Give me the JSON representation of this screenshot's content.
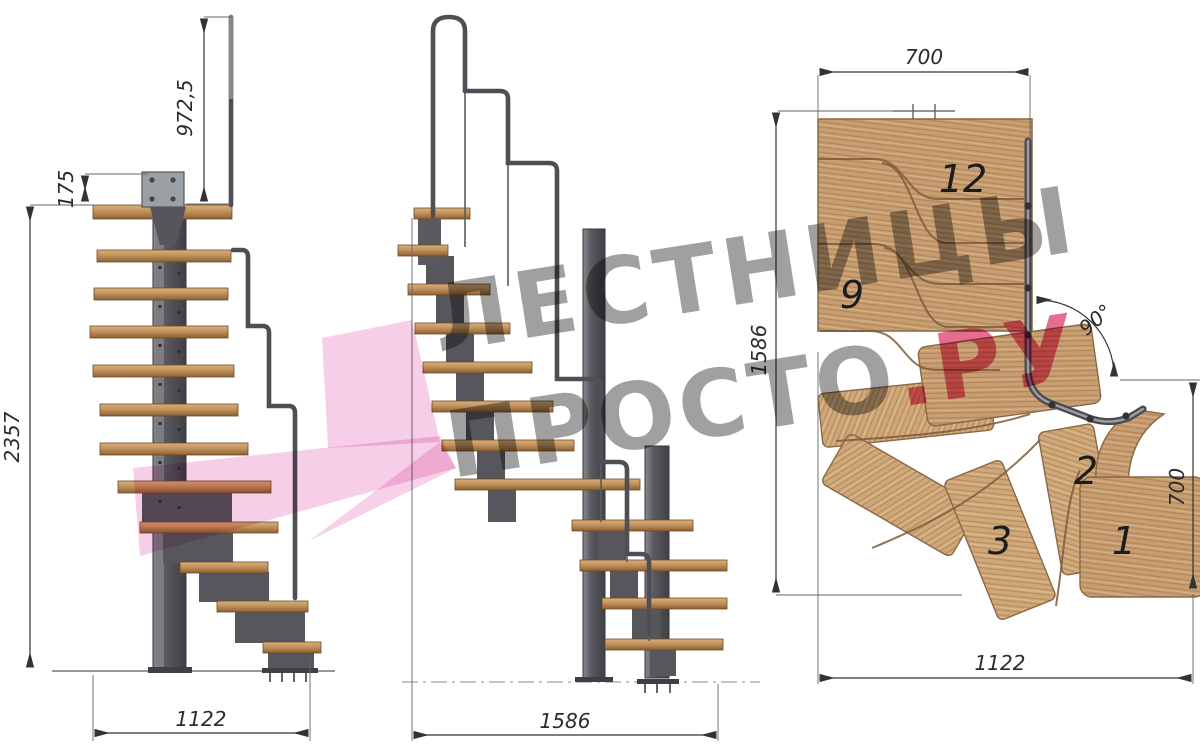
{
  "drawing": {
    "front_view": {
      "dim_rail_height": "972,5",
      "dim_plate_height": "175",
      "dim_total_height": "2357",
      "dim_width": "1122"
    },
    "side_view": {
      "dim_width": "1586"
    },
    "plan_view": {
      "dim_top_width": "700",
      "dim_left_height": "1586",
      "dim_turn_angle": "90°",
      "dim_right_depth": "700",
      "dim_bottom_width": "1122",
      "step_numbers": {
        "top": "12",
        "mid": "9",
        "s3": "3",
        "s2": "2",
        "s1": "1"
      }
    },
    "watermark": {
      "line1": "ЛЕСТНИЦЫ",
      "line2_gray": "ПРОСТО",
      "line2_pink": ".РУ",
      "gray": "#8f8f8f",
      "pink": "#e2537f",
      "arrow_pink": "#f4c2e1"
    },
    "colors": {
      "wood_top": "#c89e72",
      "wood_face": "#c2925c",
      "steel": "#4e4e54",
      "dim_line": "#3a3a3a"
    }
  }
}
